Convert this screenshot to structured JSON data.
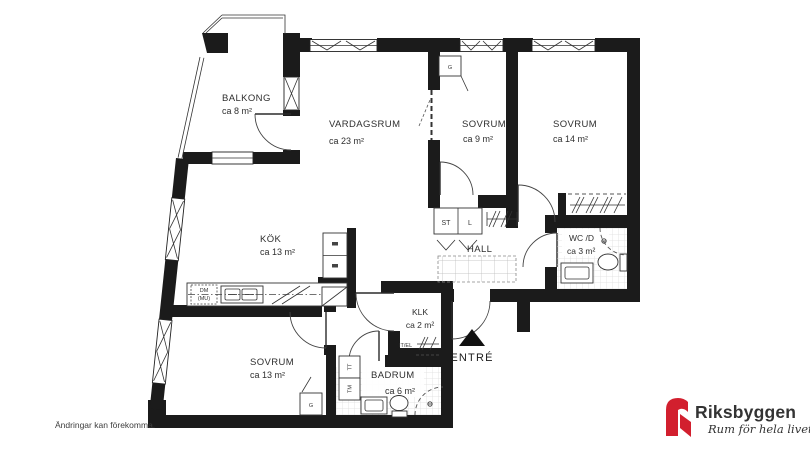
{
  "plan": {
    "rooms": {
      "balkong": {
        "name": "BALKONG",
        "area": "ca 8 m²"
      },
      "vardagsrum": {
        "name": "VARDAGSRUM",
        "area": "ca 23 m²"
      },
      "sovrum_9": {
        "name": "SOVRUM",
        "area": "ca 9 m²"
      },
      "sovrum_14": {
        "name": "SOVRUM",
        "area": "ca 14 m²"
      },
      "kok": {
        "name": "KÖK",
        "area": "ca 13 m²"
      },
      "hall": {
        "name": "HALL"
      },
      "wc_dusch": {
        "name": "WC /D",
        "area": "ca 3 m²"
      },
      "klk": {
        "name": "KLK",
        "area": "ca 2 m²"
      },
      "sovrum_13": {
        "name": "SOVRUM",
        "area": "ca 13 m²"
      },
      "badrum": {
        "name": "BADRUM",
        "area": "ca 6 m²"
      },
      "entre": {
        "name": "ENTRÉ"
      }
    },
    "fixture_labels": {
      "garderob_1": "G",
      "garderob_2": "G",
      "stad": "ST",
      "linne": "L",
      "diskmaskin": "DM",
      "micro": "(MU)",
      "torktumlare": "TT",
      "tvattmaskin": "TM",
      "it_el": "IT/EL"
    }
  },
  "footer": {
    "disclaimer": "Ändringar kan förekomma."
  },
  "brand": {
    "name": "Riksbyggen",
    "tagline": "Rum för hela livet",
    "red": "#d21f2e",
    "gray": "#8f9193"
  }
}
